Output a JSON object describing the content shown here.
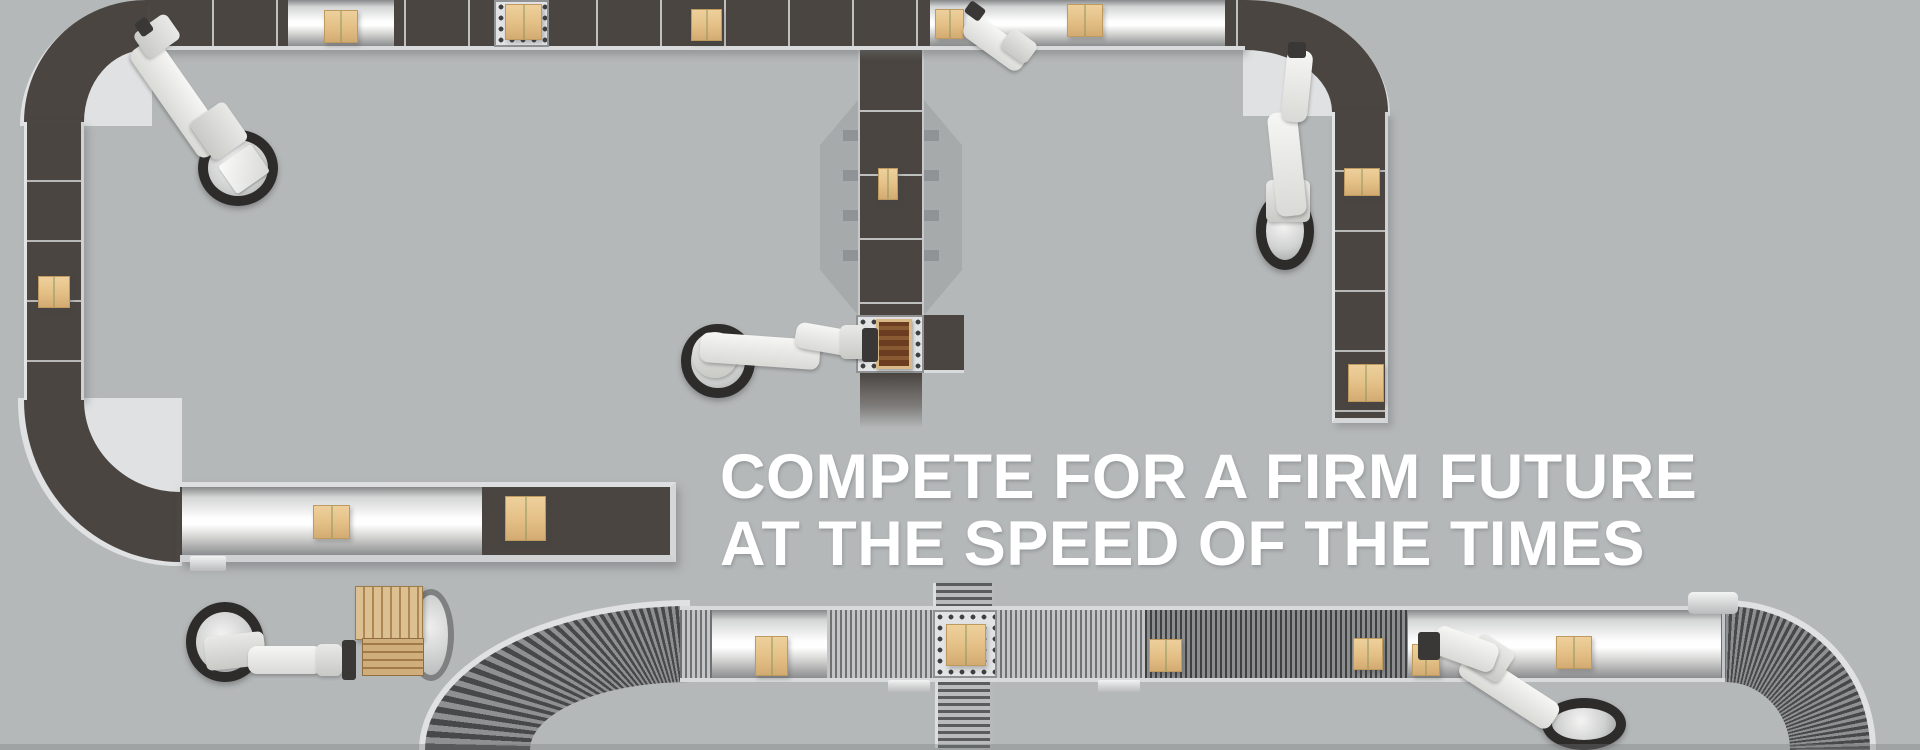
{
  "hero": {
    "headline_line1": "COMPETE FOR A FIRM FUTURE",
    "headline_line2": "AT THE SPEED OF THE TIMES",
    "text_color": "#ffffff"
  },
  "scene": {
    "background_color": "#b5b8b9",
    "conveyor_belt_color": "#4a4541",
    "rail_color": "#dcdedf",
    "roller_curve_color": "#47484a",
    "box_color": "#e3bf85",
    "robot_color": "#efefed",
    "robot_base_color": "#2e2c2b",
    "wood_pallet_color": "#d3ae79",
    "robot_count": 6,
    "box_count": 17
  }
}
